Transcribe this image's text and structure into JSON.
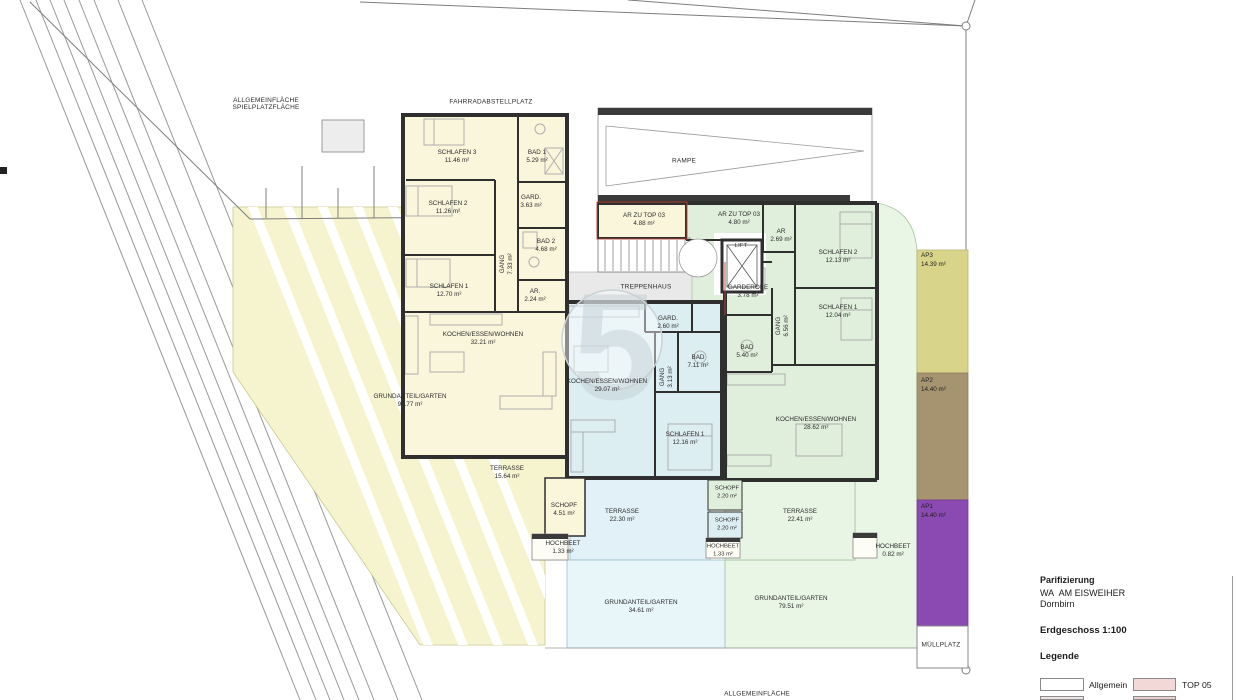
{
  "watermark": "5",
  "site": {
    "allgemein_line1": "ALLGEMEINFLÄCHE",
    "allgemein_line2": "SPIELPLATZFLÄCHE",
    "fahrradabstellplatz": "FAHRRADABSTELLPLATZ",
    "rampe": "RAMPE",
    "treppenhaus": "TREPPENHAUS",
    "lift": "LIFT",
    "muellplatz": "MÜLLPLATZ",
    "allgemeinflaeche_bottom": "ALLGEMEINFLÄCHE"
  },
  "rooms": {
    "schlafen3": {
      "name": "SCHLAFEN 3",
      "area": "11.46 m²"
    },
    "bad1": {
      "name": "BAD 1",
      "area": "5.29 m²"
    },
    "gard_left": {
      "name": "GARD.",
      "area": "3.63 m²"
    },
    "schlafen2_left": {
      "name": "SCHLAFEN 2",
      "area": "11.26 m²"
    },
    "bad2": {
      "name": "BAD 2",
      "area": "4.68 m²"
    },
    "gang_left": {
      "name": "GANG",
      "area": "7.33 m²"
    },
    "schlafen1_left": {
      "name": "SCHLAFEN 1",
      "area": "12.70 m²"
    },
    "ar_left": {
      "name": "AR.",
      "area": "2.24 m²"
    },
    "kochen_left": {
      "name": "KOCHEN/ESSEN/WOHNEN",
      "area": "32.21 m²"
    },
    "grundanteil_left": {
      "name": "GRUNDANTEIL/GARTEN",
      "area": "94.77 m²"
    },
    "terrasse_left": {
      "name": "TERRASSE",
      "area": "15.64 m²"
    },
    "schopf_left": {
      "name": "SCHOPF",
      "area": "4.51 m²"
    },
    "hochbeet_left": {
      "name": "HOCHBEET",
      "area": "1.33 m²"
    },
    "ar_zu_top03_a": {
      "name": "AR ZU TOP 03",
      "area": "4.88 m²"
    },
    "ar_zu_top03_b": {
      "name": "AR ZU TOP 03",
      "area": "4.80 m²"
    },
    "ar_right": {
      "name": "AR",
      "area": "2.69 m²"
    },
    "gard_mid": {
      "name": "GARD.",
      "area": "2.60 m²"
    },
    "kochen_mid": {
      "name": "KOCHEN/ESSEN/WOHNEN",
      "area": "29.07 m²"
    },
    "gang_mid": {
      "name": "GANG",
      "area": "3.13 m²"
    },
    "bad_mid": {
      "name": "BAD",
      "area": "7.11 m²"
    },
    "schlafen1_mid": {
      "name": "SCHLAFEN 1",
      "area": "12.16 m²"
    },
    "terrasse_mid": {
      "name": "TERRASSE",
      "area": "22.30 m²"
    },
    "schopf_green": {
      "name": "SCHOPF",
      "area": "2.20 m²"
    },
    "schopf_blue": {
      "name": "SCHOPF",
      "area": "2.20 m²"
    },
    "hochbeet_mid": {
      "name": "HOCHBEET",
      "area": "1.33 m²"
    },
    "grundanteil_mid": {
      "name": "GRUNDANTEIL/GARTEN",
      "area": "34.61 m²"
    },
    "garderobe": {
      "name": "GARDEROBE",
      "area": "3.78 m²"
    },
    "schlafen2_right": {
      "name": "SCHLAFEN 2",
      "area": "12.13 m²"
    },
    "schlafen1_right": {
      "name": "SCHLAFEN 1",
      "area": "12.04 m²"
    },
    "gang_right": {
      "name": "GANG",
      "area": "6.56 m²"
    },
    "bad_right": {
      "name": "BAD",
      "area": "5.40 m²"
    },
    "kochen_right": {
      "name": "KOCHEN/ESSEN/WOHNEN",
      "area": "28.62 m²"
    },
    "terrasse_right": {
      "name": "TERRASSE",
      "area": "22.41 m²"
    },
    "hochbeet_right": {
      "name": "HOCHBEET",
      "area": "0.82 m²"
    },
    "grundanteil_right": {
      "name": "GRUNDANTEIL/GARTEN",
      "area": "79.51 m²"
    }
  },
  "parking": {
    "ap3": {
      "name": "AP3",
      "area": "14.39 m²"
    },
    "ap2": {
      "name": "AP2",
      "area": "14.40 m²"
    },
    "ap1": {
      "name": "AP1",
      "area": "14.40 m²"
    }
  },
  "title_block": {
    "title": "Parifizierung",
    "project_name": "WA  AM EISWEIHER",
    "city": "Dornbirn",
    "floor_scale": "Erdgeschoss 1:100",
    "legend_heading": "Legende",
    "legend": [
      {
        "label": "Allgemein",
        "color": "#ffffff"
      },
      {
        "label": "TOP 05",
        "color": "#f2d8d6"
      }
    ]
  },
  "colors": {
    "yellow_unit": "#faf6dc",
    "yellow_garden": "#f6f4cf",
    "blue_unit": "#dceef2",
    "blue_terrace": "#e2f1f7",
    "blue_garden": "#e8f6fa",
    "green_unit": "#e0efdb",
    "green_garden": "#e9f5e5",
    "ap3": "#d8d48a",
    "ap2": "#a5946f",
    "ap1": "#8a4ab1",
    "wall": "#2f2f2f"
  }
}
